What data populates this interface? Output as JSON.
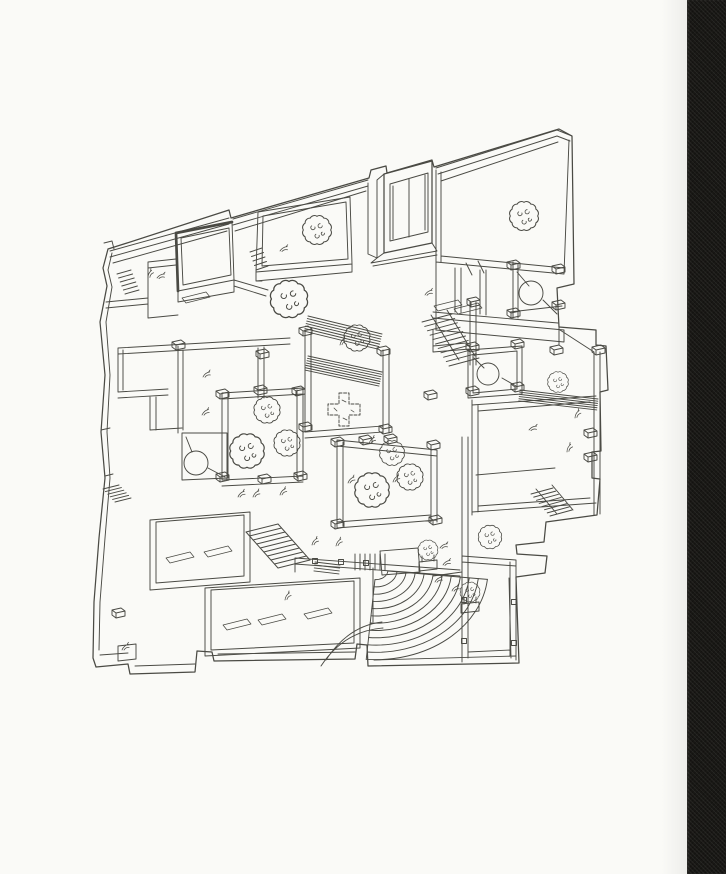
{
  "page": {
    "kind": "scanned-book-page",
    "width": 726,
    "height": 874,
    "paper_color": "#fafaf7",
    "binding_color": "#191815",
    "binding_width": 39
  },
  "drawing": {
    "type": "axonometric-floor-plan",
    "ink_color": "#4a4a44",
    "description": "hand-drawn axonometric plan of walled house with courtyards, trees, stairs and quarter-circle amphitheatre",
    "trees": [
      {
        "x": 317,
        "y": 230,
        "s": 1.05
      },
      {
        "x": 524,
        "y": 216,
        "s": 1.05
      },
      {
        "x": 289,
        "y": 299,
        "s": 1.35
      },
      {
        "x": 357,
        "y": 338,
        "s": 0.95
      },
      {
        "x": 267,
        "y": 410,
        "s": 0.95
      },
      {
        "x": 247,
        "y": 451,
        "s": 1.25
      },
      {
        "x": 287,
        "y": 443,
        "s": 0.95
      },
      {
        "x": 372,
        "y": 490,
        "s": 1.25
      },
      {
        "x": 392,
        "y": 453,
        "s": 0.9
      },
      {
        "x": 410,
        "y": 477,
        "s": 0.95
      },
      {
        "x": 558,
        "y": 382,
        "s": 0.75
      },
      {
        "x": 490,
        "y": 537,
        "s": 0.85
      }
    ],
    "planter_trees": [
      {
        "x": 428,
        "y": 556
      },
      {
        "x": 470,
        "y": 598
      }
    ],
    "cross_trees": [
      {
        "x": 344,
        "y": 410,
        "s": 1.0
      }
    ],
    "circles": [
      {
        "x": 531,
        "y": 293,
        "r": 12
      },
      {
        "x": 488,
        "y": 374,
        "r": 11
      },
      {
        "x": 196,
        "y": 463,
        "r": 12
      }
    ],
    "caps": [
      [
        222,
        395
      ],
      [
        260,
        391
      ],
      [
        298,
        392
      ],
      [
        222,
        478
      ],
      [
        264,
        480
      ],
      [
        300,
        477
      ],
      [
        337,
        443
      ],
      [
        365,
        441
      ],
      [
        390,
        440
      ],
      [
        433,
        446
      ],
      [
        337,
        525
      ],
      [
        435,
        521
      ],
      [
        305,
        332
      ],
      [
        383,
        352
      ],
      [
        305,
        428
      ],
      [
        385,
        430
      ],
      [
        556,
        351
      ],
      [
        598,
        351
      ],
      [
        590,
        434
      ],
      [
        590,
        458
      ],
      [
        472,
        348
      ],
      [
        517,
        345
      ],
      [
        472,
        392
      ],
      [
        517,
        388
      ],
      [
        513,
        266
      ],
      [
        513,
        314
      ],
      [
        558,
        270
      ],
      [
        558,
        306
      ],
      [
        473,
        303
      ],
      [
        118,
        614
      ],
      [
        430,
        396
      ],
      [
        178,
        346
      ],
      [
        262,
        355
      ]
    ],
    "posts": [
      [
        315,
        561
      ],
      [
        341,
        562
      ],
      [
        366,
        563
      ],
      [
        464,
        600
      ],
      [
        514,
        602
      ],
      [
        464,
        641
      ],
      [
        514,
        643
      ]
    ],
    "leaves": [
      [
        148,
        278
      ],
      [
        157,
        278
      ],
      [
        280,
        251
      ],
      [
        425,
        295
      ],
      [
        203,
        377
      ],
      [
        202,
        415
      ],
      [
        238,
        497
      ],
      [
        253,
        497
      ],
      [
        280,
        495
      ],
      [
        312,
        545
      ],
      [
        336,
        546
      ],
      [
        285,
        600
      ],
      [
        575,
        418
      ],
      [
        567,
        452
      ],
      [
        529,
        430
      ],
      [
        440,
        548
      ],
      [
        443,
        565
      ],
      [
        435,
        582
      ],
      [
        452,
        591
      ],
      [
        122,
        650
      ],
      [
        348,
        483
      ],
      [
        393,
        482
      ],
      [
        369,
        444
      ],
      [
        340,
        345
      ]
    ],
    "mats": [
      [
        196,
        295
      ],
      [
        180,
        555
      ],
      [
        218,
        549
      ],
      [
        237,
        622
      ],
      [
        272,
        617
      ],
      [
        318,
        611
      ],
      [
        448,
        303
      ],
      [
        468,
        306
      ]
    ],
    "stairs": [
      {
        "x1": 437,
        "y1": 318,
        "x2": 464,
        "y2": 362,
        "n": 11,
        "tx": 15,
        "ty": -4
      },
      {
        "x1": 262,
        "y1": 528,
        "x2": 294,
        "y2": 564,
        "n": 10,
        "tx": 16,
        "ty": -4
      },
      {
        "x1": 542,
        "y1": 491,
        "x2": 561,
        "y2": 513,
        "n": 8,
        "tx": 11,
        "ty": -3
      },
      {
        "x1": 111,
        "y1": 487,
        "x2": 123,
        "y2": 500,
        "n": 6,
        "tx": 8,
        "ty": -2
      },
      {
        "x1": 124,
        "y1": 272,
        "x2": 132,
        "y2": 292,
        "n": 6,
        "tx": 7,
        "ty": -2
      },
      {
        "x1": 256,
        "y1": 250,
        "x2": 262,
        "y2": 268,
        "n": 5,
        "tx": 6,
        "ty": -2
      }
    ],
    "bands": [
      {
        "x1": 308,
        "y1": 316,
        "x2": 382,
        "y2": 334,
        "n": 7,
        "gap": 2.6
      },
      {
        "x1": 308,
        "y1": 356,
        "x2": 382,
        "y2": 372,
        "n": 7,
        "gap": 2.4
      },
      {
        "x1": 520,
        "y1": 390,
        "x2": 598,
        "y2": 399,
        "n": 6,
        "gap": 2.2
      },
      {
        "x1": 315,
        "y1": 562,
        "x2": 340,
        "y2": 565,
        "n": 4,
        "gap": 3
      },
      {
        "x1": 385,
        "y1": 554,
        "x2": 385,
        "y2": 570,
        "n": 7,
        "gap": 5
      }
    ],
    "amphitheatre": {
      "cx": 376,
      "cy": 570,
      "rx0": 12,
      "rx1": 112,
      "ratio": 0.8,
      "n": 12,
      "a0": 6,
      "a1": 95
    }
  }
}
